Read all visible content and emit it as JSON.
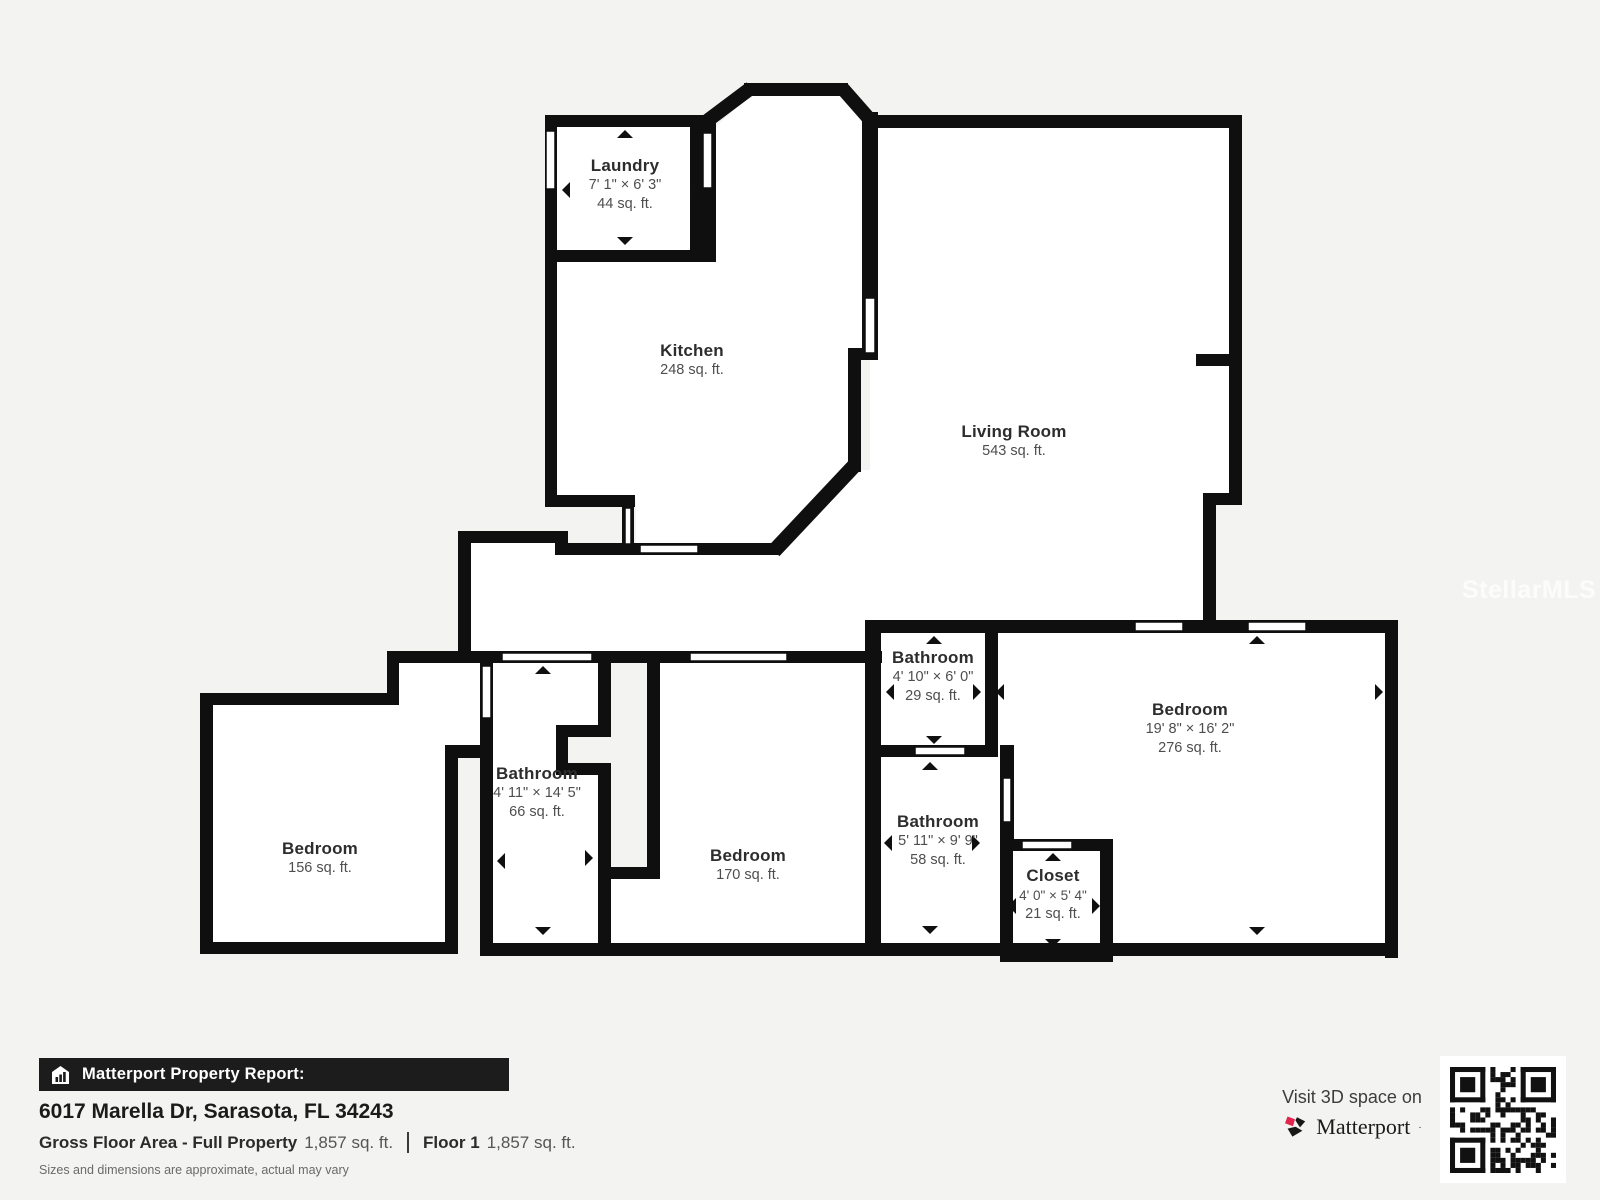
{
  "colors": {
    "wall": "#0f0f0f",
    "background": "#f3f3f1",
    "room_fill": "#ffffff",
    "accent_red": "#e2254d",
    "bar_bg": "#1c1c1c"
  },
  "watermark": "StellarMLS",
  "rooms": [
    {
      "name": "Laundry",
      "dims": "7' 1\" × 6' 3\"",
      "area": "44 sq. ft."
    },
    {
      "name": "Kitchen",
      "dims": "",
      "area": "248 sq. ft."
    },
    {
      "name": "Living Room",
      "dims": "",
      "area": "543 sq. ft."
    },
    {
      "name": "Bathroom",
      "dims": "4' 11\" × 14' 5\"",
      "area": "66 sq. ft."
    },
    {
      "name": "Bedroom",
      "dims": "",
      "area": "156 sq. ft."
    },
    {
      "name": "Bedroom",
      "dims": "",
      "area": "170 sq. ft."
    },
    {
      "name": "Bathroom",
      "dims": "4' 10\" × 6' 0\"",
      "area": "29 sq. ft."
    },
    {
      "name": "Bathroom",
      "dims": "5' 11\" × 9' 9\"",
      "area": "58 sq. ft."
    },
    {
      "name": "Closet",
      "dims": "4' 0\" × 5' 4\"",
      "area": "21 sq. ft."
    },
    {
      "name": "Bedroom",
      "dims": "19' 8\" × 16' 2\"",
      "area": "276 sq. ft."
    }
  ],
  "footer": {
    "report_label": "Matterport Property Report:",
    "address": "6017 Marella Dr, Sarasota, FL 34243",
    "gross_label": "Gross Floor Area - Full Property",
    "gross_value": "1,857 sq. ft.",
    "floor_label": "Floor 1",
    "floor_value": "1,857 sq. ft.",
    "disclaimer": "Sizes and dimensions are approximate, actual may vary",
    "visit_text": "Visit 3D space on",
    "brand": "Matterport",
    "brand_mark": "·"
  }
}
